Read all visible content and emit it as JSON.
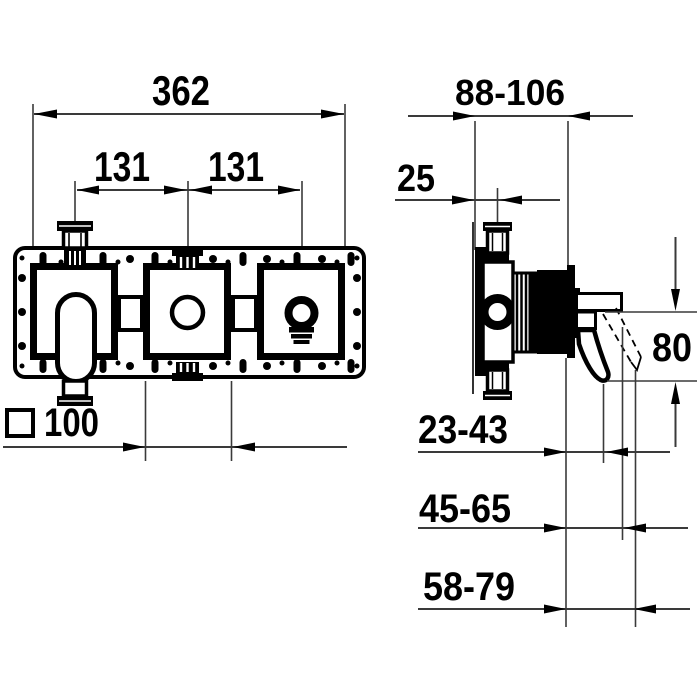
{
  "drawing": {
    "type": "technical-installation-drawing",
    "views": [
      "front-view",
      "side-section-view"
    ]
  },
  "dims": {
    "front": {
      "overall_width": "362",
      "spacing_left": "131",
      "spacing_right": "131",
      "square_size": "100"
    },
    "side": {
      "depth_range": "88-106",
      "inlet_offset": "25",
      "handle_drop": "80",
      "depth_min": "23-43",
      "depth_mid": "45-65",
      "depth_max": "58-79"
    }
  },
  "symbols": {
    "square": "square-outline-symbol"
  },
  "colors": {
    "line": "#000000",
    "dim_line": "#3a3a3a",
    "background": "#ffffff"
  }
}
